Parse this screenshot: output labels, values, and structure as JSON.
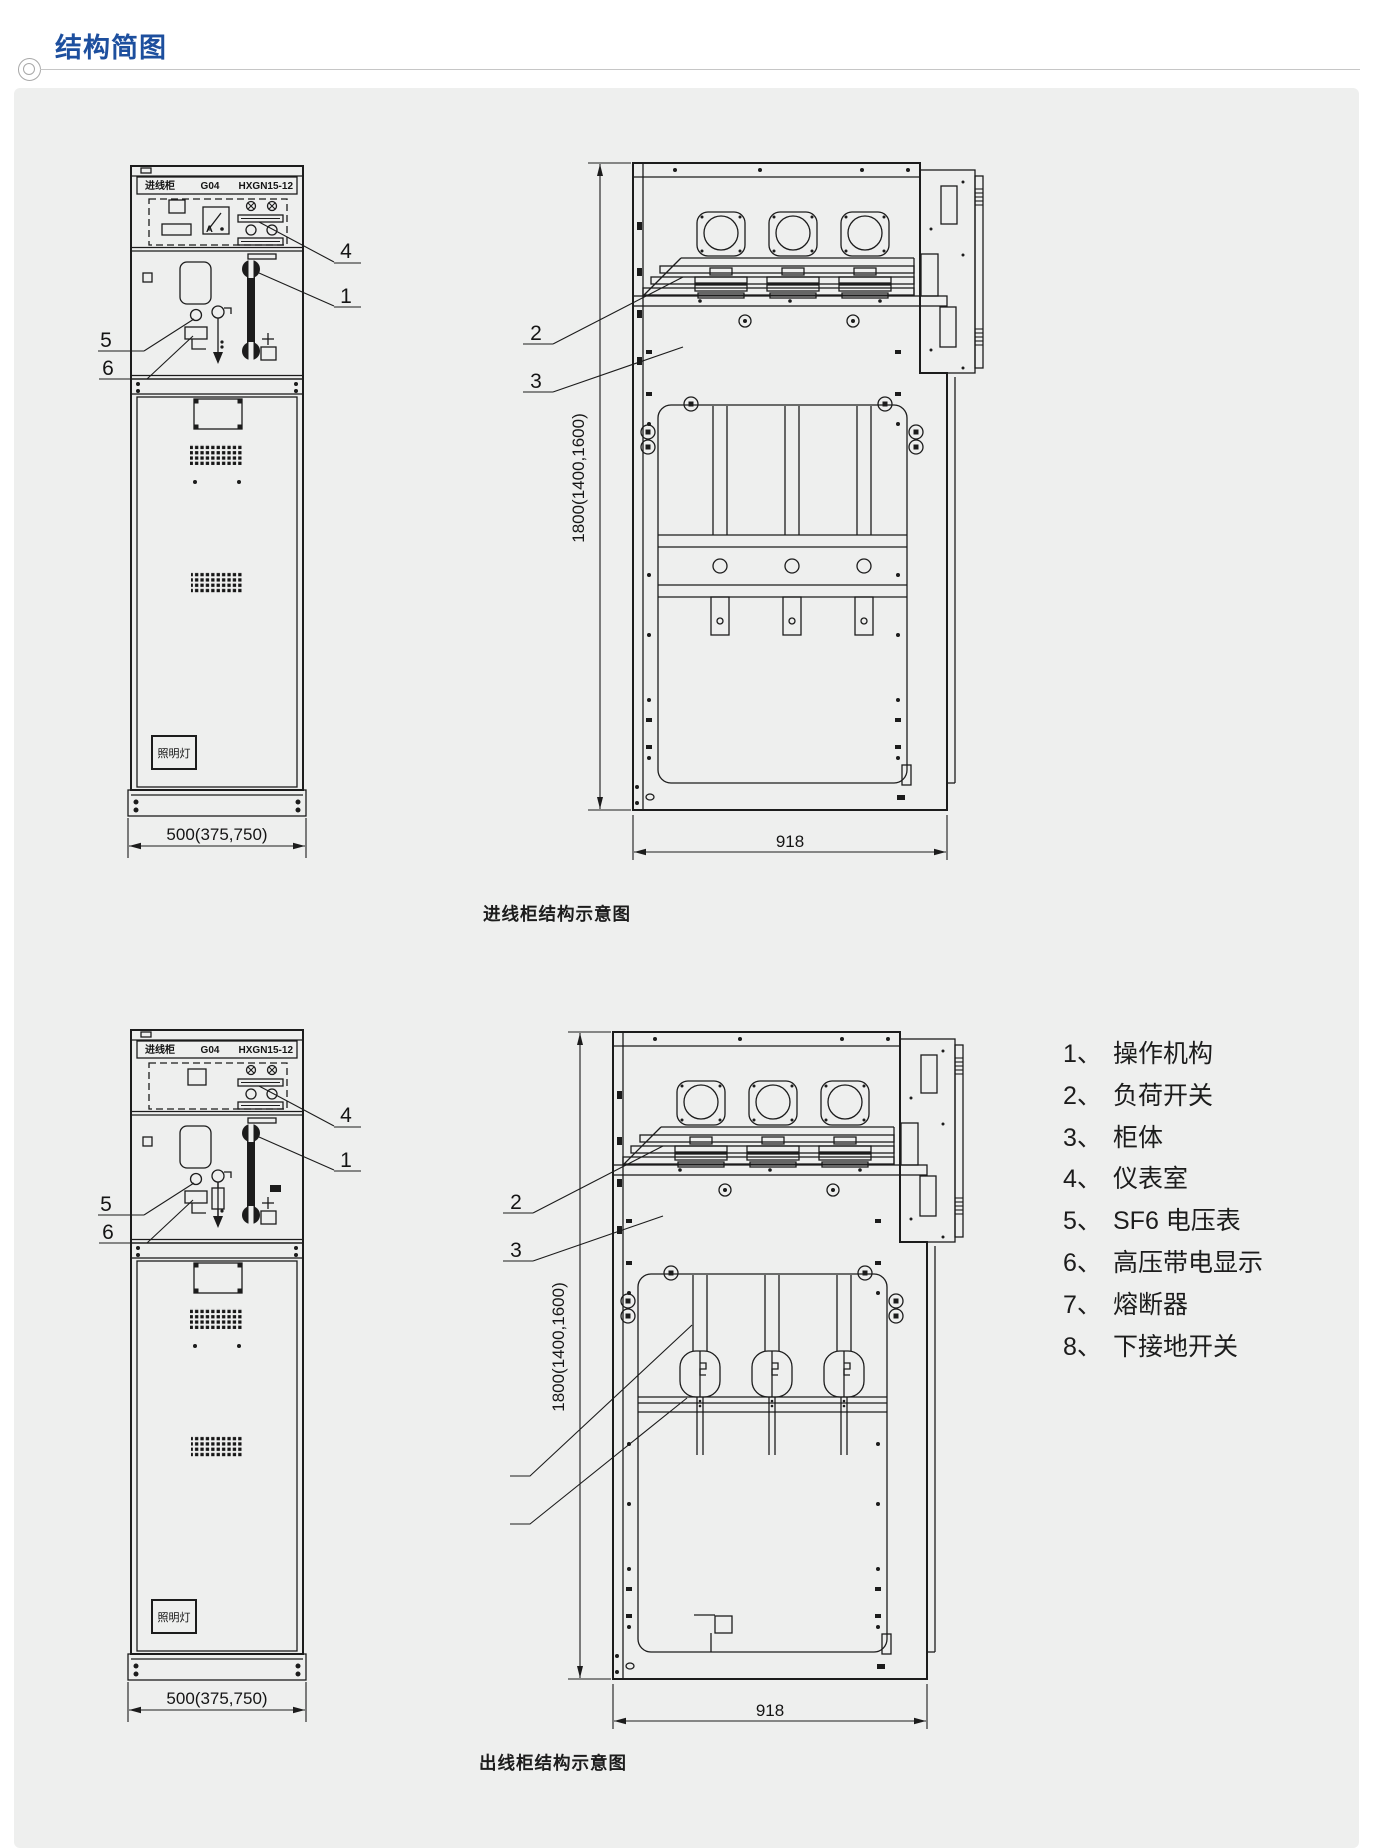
{
  "header": {
    "title": "结构简图"
  },
  "colors": {
    "accent": "#1d4f9e",
    "panel_bg": "#eeefee",
    "ink": "#1c1c1c"
  },
  "legend": {
    "items": [
      {
        "num": "1、",
        "label": "操作机构"
      },
      {
        "num": "2、",
        "label": "负荷开关"
      },
      {
        "num": "3、",
        "label": "柜体"
      },
      {
        "num": "4、",
        "label": "仪表室"
      },
      {
        "num": "5、",
        "label": "SF6 电压表"
      },
      {
        "num": "6、",
        "label": "高压带电显示"
      },
      {
        "num": "7、",
        "label": "熔断器"
      },
      {
        "num": "8、",
        "label": "下接地开关"
      }
    ]
  },
  "diagrams": {
    "top": {
      "caption": "进线柜结构示意图",
      "front": {
        "nameplate_left": "进线柜",
        "nameplate_model": "G04",
        "nameplate_type": "HXGN15-12",
        "ammeter_label": "A",
        "lamp_label": "照明灯",
        "width_dim": "500(375,750)"
      },
      "side": {
        "height_dim": "1800(1400,1600)",
        "width_dim": "918"
      },
      "callouts": {
        "c1": "1",
        "c2": "2",
        "c3": "3",
        "c4": "4",
        "c5": "5",
        "c6": "6"
      }
    },
    "bottom": {
      "caption": "出线柜结构示意图",
      "front": {
        "nameplate_left": "进线柜",
        "nameplate_model": "G04",
        "nameplate_type": "HXGN15-12",
        "lamp_label": "照明灯",
        "width_dim": "500(375,750)"
      },
      "side": {
        "height_dim": "1800(1400,1600)",
        "width_dim": "918"
      },
      "callouts": {
        "c1": "1",
        "c2": "2",
        "c3": "3",
        "c4": "4",
        "c5": "5",
        "c6": "6"
      }
    }
  }
}
